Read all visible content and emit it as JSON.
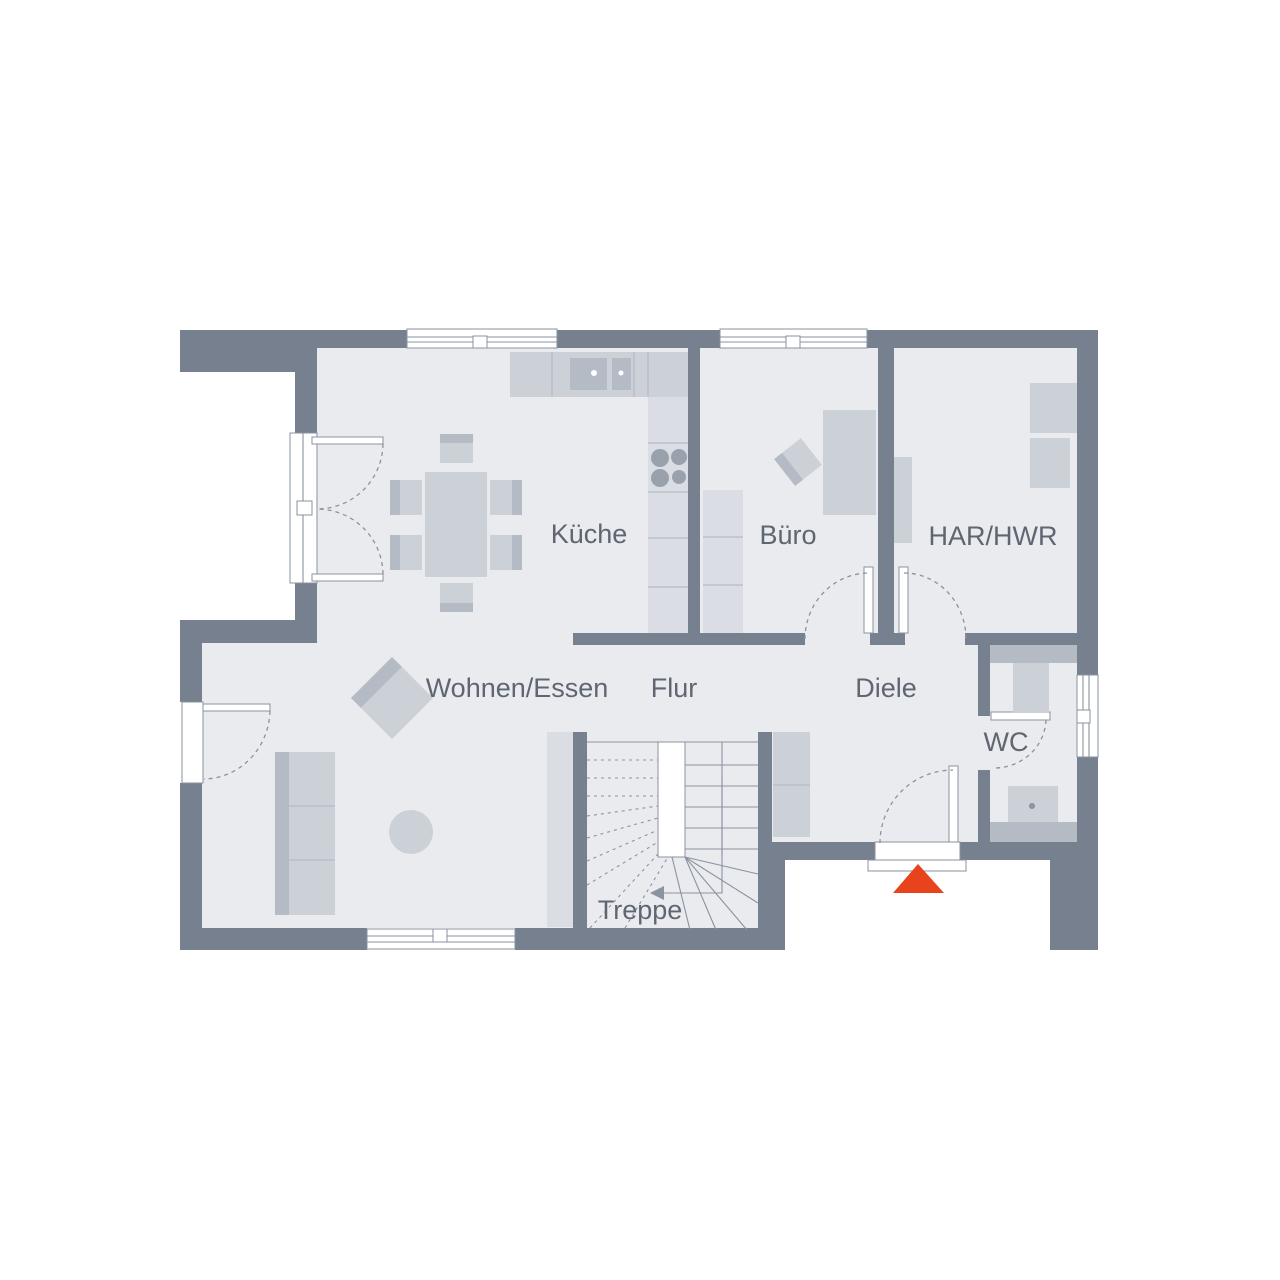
{
  "floorplan": {
    "rooms": [
      {
        "id": "wohnen-essen",
        "label": "Wohnen/Essen"
      },
      {
        "id": "kueche",
        "label": "Küche"
      },
      {
        "id": "buero",
        "label": "Büro"
      },
      {
        "id": "har-hwr",
        "label": "HAR/HWR"
      },
      {
        "id": "flur",
        "label": "Flur"
      },
      {
        "id": "diele",
        "label": "Diele"
      },
      {
        "id": "wc",
        "label": "WC"
      },
      {
        "id": "treppe",
        "label": "Treppe"
      }
    ],
    "entrance_marker": {
      "type": "triangle",
      "color": "#E8431C"
    },
    "colors": {
      "wall": "#77808E",
      "floor": "#E9EBEF",
      "furn": "#CCD1D8",
      "furn_light": "#DADDE3",
      "furn_dark": "#B5BBC5",
      "line": "#8A93A0",
      "label": "#606671",
      "accent": "#E8431C",
      "bg": "#FFFFFF"
    }
  }
}
